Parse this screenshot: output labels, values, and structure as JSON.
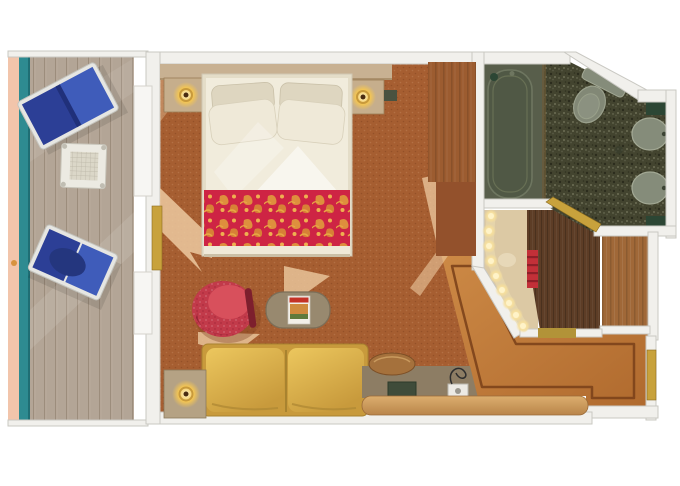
{
  "scene": {
    "name": "cruise-ship balcony stateroom floor plan",
    "style": "top-down rendered floor plan, no text labels",
    "background": "#ffffff"
  },
  "palette": {
    "hull": "#f2c5ab",
    "railing": "#2e8b91",
    "railing_dark": "#1f6e74",
    "deck": "#b3a596",
    "deck_line": "#9c8d7c",
    "wall": "#f1f0ec",
    "wall_edge": "#c9c8c2",
    "window": "#f7f6f3",
    "carpet": "#a65e31",
    "carpet_light": "#ecc9a0",
    "headboard": "#c8b192",
    "nightstand": "#c6ae8c",
    "nightstand_edge": "#9a7b55",
    "lamp_gold": "#c89a3c",
    "lamp_center": "#4a2c12",
    "bed_frame": "#e4ddc8",
    "bed_sheet": "#f1ecdc",
    "pillow": "#efe9d8",
    "pillow_dark": "#ded6c0",
    "blanket_red": "#ce2444",
    "blanket_gold": "#e09a3c",
    "chair_red": "#c23a4a",
    "chair_red_dark": "#8e2133",
    "chair_seat": "#d8505c",
    "table_top": "#98896f",
    "magazine": "#f2efe8",
    "sofa_hi": "#ecc75e",
    "sofa_lo": "#c89a3c",
    "sofa_seam": "#a8832f",
    "side_table": "#b5a284",
    "desk": "#8d7d64",
    "stool": "#a5713c",
    "tray": "#3f4c3a",
    "appliance": "#eceae4",
    "shelf_hi": "#dcae6e",
    "shelf_lo": "#b9854a",
    "entry_hi": "#cd8a46",
    "entry_lo": "#b06a2e",
    "entry_border": "#7c431b",
    "corridor": "#5d3d26",
    "closet": "#a06838",
    "wardrobe": "#9c5c30",
    "wardrobe2": "#93512c",
    "bath_floor": "#43442f",
    "tub_room": "#585e4b",
    "tub": "#505845",
    "tub_edge": "#6e7660",
    "fixture": "#858c7a",
    "fixture_edge": "#a2a894",
    "counter_green": "#2c4634",
    "gold": "#c8a23c",
    "gold_dark": "#8a6a1e",
    "threshold": "#b29338",
    "vanity": "#dcc9a4",
    "vanity_glow": "#f7df9a",
    "jackets": "#c23038",
    "jackets_stripe": "#8e1f28",
    "lounger_dark": "#2c3f96",
    "lounger_light": "#3f5cba",
    "lounger_frame": "#e6e6e2",
    "balcony_table": "#eceae2"
  },
  "rooms": [
    {
      "id": "balcony",
      "label": "balcony",
      "furniture": [
        "lounge-chair",
        "lounge-chair",
        "deck-table"
      ]
    },
    {
      "id": "main-cabin",
      "label": "bedroom-sitting-area",
      "furniture": [
        "double-bed",
        "pillows",
        "red-damask-blanket",
        "nightstand",
        "nightstand",
        "table-lamp",
        "table-lamp",
        "wardrobe",
        "tub-armchair",
        "oval-coffee-table",
        "magazine",
        "sofa",
        "side-table",
        "desk",
        "stool",
        "hairdryer",
        "tray",
        "shelf"
      ]
    },
    {
      "id": "bathroom",
      "label": "bathroom",
      "furniture": [
        "bathtub",
        "toilet",
        "sink",
        "sink",
        "counter",
        "counter"
      ]
    },
    {
      "id": "vanity-nook",
      "label": "lighted-vanity",
      "furniture": [
        "vanity-light-strip",
        "life-jackets",
        "basin"
      ]
    },
    {
      "id": "corridor",
      "label": "entry-corridor",
      "furniture": []
    },
    {
      "id": "closet",
      "label": "closet",
      "furniture": []
    },
    {
      "id": "entry",
      "label": "entryway",
      "furniture": [
        "cabin-door",
        "bathroom-door",
        "balcony-door",
        "threshold"
      ]
    }
  ]
}
